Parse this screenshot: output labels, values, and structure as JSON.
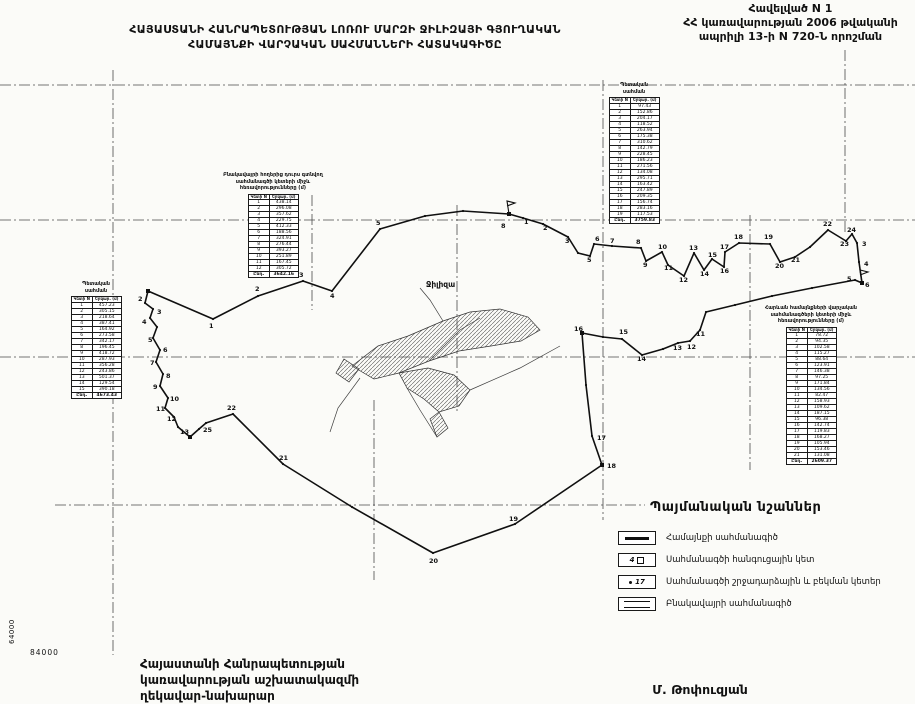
{
  "header": {
    "title_line1": "ՀԱՅԱՍՏԱՆԻ ՀԱՆՐԱՊԵՏՈՒԹՅԱՆ ԼՈՌՈՒ ՄԱՐԶԻ ՋԻԼԻԶԱՅԻ ԳՅՈՒՂԱԿԱՆ",
    "title_line2": "ՀԱՄԱՅՆՔԻ ՎԱՐՉԱԿԱՆ ՍԱՀՄԱՆՆԵՐԻ ՀԱՏԱԿԱԳԻԾԸ",
    "annex_line1": "Հավելված N 1",
    "annex_line2": "ՀՀ կառավարության 2006 թվականի",
    "annex_line3": "ապրիլի 13-ի N 720-Ն որոշման"
  },
  "map": {
    "settlement_label": "Ջիլիզա",
    "settlement_label_x": 426,
    "settlement_label_y": 287,
    "coord_vertical": "64000",
    "coord_horizontal": "84000",
    "boundary": [
      [
        148,
        291
      ],
      [
        145,
        303
      ],
      [
        153,
        309
      ],
      [
        150,
        318
      ],
      [
        157,
        327
      ],
      [
        153,
        338
      ],
      [
        160,
        350
      ],
      [
        156,
        362
      ],
      [
        163,
        374
      ],
      [
        160,
        386
      ],
      [
        168,
        398
      ],
      [
        165,
        408
      ],
      [
        174,
        417
      ],
      [
        178,
        427
      ],
      [
        190,
        437
      ],
      [
        199,
        429
      ],
      [
        206,
        423
      ],
      [
        233,
        414
      ],
      [
        283,
        464
      ],
      [
        352,
        507
      ],
      [
        433,
        553
      ],
      [
        515,
        524
      ],
      [
        602,
        465
      ],
      [
        592,
        436
      ],
      [
        586,
        385
      ],
      [
        582,
        333
      ],
      [
        603,
        337
      ],
      [
        622,
        339
      ],
      [
        642,
        355
      ],
      [
        663,
        349
      ],
      [
        678,
        343
      ],
      [
        690,
        341
      ],
      [
        700,
        330
      ],
      [
        706,
        312
      ],
      [
        735,
        305
      ],
      [
        772,
        296
      ],
      [
        812,
        288
      ],
      [
        855,
        280
      ],
      [
        862,
        283
      ],
      [
        859,
        262
      ],
      [
        857,
        243
      ],
      [
        852,
        234
      ],
      [
        846,
        241
      ],
      [
        828,
        230
      ],
      [
        810,
        247
      ],
      [
        795,
        257
      ],
      [
        780,
        262
      ],
      [
        770,
        244
      ],
      [
        739,
        243
      ],
      [
        725,
        252
      ],
      [
        724,
        267
      ],
      [
        712,
        259
      ],
      [
        704,
        270
      ],
      [
        694,
        253
      ],
      [
        684,
        276
      ],
      [
        668,
        265
      ],
      [
        662,
        252
      ],
      [
        646,
        261
      ],
      [
        641,
        248
      ],
      [
        612,
        246
      ],
      [
        594,
        244
      ],
      [
        590,
        256
      ],
      [
        578,
        253
      ],
      [
        568,
        237
      ],
      [
        543,
        224
      ],
      [
        523,
        218
      ],
      [
        509,
        214
      ],
      [
        463,
        211
      ],
      [
        425,
        216
      ],
      [
        380,
        229
      ],
      [
        332,
        291
      ],
      [
        303,
        281
      ],
      [
        258,
        296
      ],
      [
        213,
        319
      ]
    ],
    "point_labels": [
      {
        "t": "1",
        "x": 209,
        "y": 328
      },
      {
        "t": "2",
        "x": 138,
        "y": 301
      },
      {
        "t": "3",
        "x": 157,
        "y": 314
      },
      {
        "t": "4",
        "x": 142,
        "y": 324
      },
      {
        "t": "5",
        "x": 148,
        "y": 342
      },
      {
        "t": "6",
        "x": 163,
        "y": 352
      },
      {
        "t": "7",
        "x": 150,
        "y": 365
      },
      {
        "t": "8",
        "x": 166,
        "y": 378
      },
      {
        "t": "9",
        "x": 153,
        "y": 389
      },
      {
        "t": "10",
        "x": 170,
        "y": 401
      },
      {
        "t": "11",
        "x": 156,
        "y": 411
      },
      {
        "t": "12",
        "x": 167,
        "y": 421
      },
      {
        "t": "13",
        "x": 180,
        "y": 434
      },
      {
        "t": "25",
        "x": 203,
        "y": 432
      },
      {
        "t": "22",
        "x": 227,
        "y": 410
      },
      {
        "t": "21",
        "x": 279,
        "y": 460
      },
      {
        "t": "20",
        "x": 429,
        "y": 563
      },
      {
        "t": "19",
        "x": 509,
        "y": 521
      },
      {
        "t": "18",
        "x": 607,
        "y": 468
      },
      {
        "t": "17",
        "x": 597,
        "y": 440
      },
      {
        "t": "16",
        "x": 574,
        "y": 331
      },
      {
        "t": "15",
        "x": 619,
        "y": 334
      },
      {
        "t": "14",
        "x": 637,
        "y": 361
      },
      {
        "t": "13",
        "x": 673,
        "y": 350
      },
      {
        "t": "12",
        "x": 687,
        "y": 349
      },
      {
        "t": "11",
        "x": 696,
        "y": 336
      },
      {
        "t": "2",
        "x": 255,
        "y": 291
      },
      {
        "t": "3",
        "x": 299,
        "y": 277
      },
      {
        "t": "4",
        "x": 330,
        "y": 298
      },
      {
        "t": "5",
        "x": 376,
        "y": 225
      },
      {
        "t": "8",
        "x": 501,
        "y": 228
      },
      {
        "t": "1",
        "x": 524,
        "y": 224
      },
      {
        "t": "2",
        "x": 543,
        "y": 230
      },
      {
        "t": "3",
        "x": 565,
        "y": 243
      },
      {
        "t": "5",
        "x": 587,
        "y": 262
      },
      {
        "t": "6",
        "x": 595,
        "y": 241
      },
      {
        "t": "7",
        "x": 610,
        "y": 243
      },
      {
        "t": "8",
        "x": 636,
        "y": 244
      },
      {
        "t": "9",
        "x": 643,
        "y": 267
      },
      {
        "t": "10",
        "x": 658,
        "y": 249
      },
      {
        "t": "11",
        "x": 664,
        "y": 270
      },
      {
        "t": "12",
        "x": 679,
        "y": 282
      },
      {
        "t": "13",
        "x": 689,
        "y": 250
      },
      {
        "t": "14",
        "x": 700,
        "y": 276
      },
      {
        "t": "15",
        "x": 708,
        "y": 257
      },
      {
        "t": "16",
        "x": 720,
        "y": 273
      },
      {
        "t": "17",
        "x": 720,
        "y": 249
      },
      {
        "t": "18",
        "x": 734,
        "y": 239
      },
      {
        "t": "19",
        "x": 764,
        "y": 239
      },
      {
        "t": "20",
        "x": 775,
        "y": 268
      },
      {
        "t": "21",
        "x": 791,
        "y": 262
      },
      {
        "t": "22",
        "x": 823,
        "y": 226
      },
      {
        "t": "23",
        "x": 840,
        "y": 246
      },
      {
        "t": "24",
        "x": 847,
        "y": 232
      },
      {
        "t": "3",
        "x": 862,
        "y": 246
      },
      {
        "t": "4",
        "x": 864,
        "y": 266
      },
      {
        "t": "5",
        "x": 847,
        "y": 281
      },
      {
        "t": "6",
        "x": 865,
        "y": 287
      }
    ],
    "junctions": [
      [
        148,
        291
      ],
      [
        509,
        214
      ],
      [
        190,
        437
      ],
      [
        862,
        283
      ],
      [
        582,
        333
      ],
      [
        602,
        465
      ]
    ],
    "flags": [
      [
        509,
        214
      ],
      [
        862,
        283
      ]
    ],
    "settlement": [
      [
        [
          352,
          366
        ],
        [
          378,
          346
        ],
        [
          408,
          336
        ],
        [
          443,
          321
        ],
        [
          470,
          312
        ],
        [
          500,
          309
        ],
        [
          528,
          317
        ],
        [
          540,
          330
        ],
        [
          521,
          341
        ],
        [
          491,
          346
        ],
        [
          459,
          351
        ],
        [
          429,
          361
        ],
        [
          399,
          373
        ],
        [
          374,
          379
        ]
      ],
      [
        [
          399,
          373
        ],
        [
          428,
          368
        ],
        [
          454,
          375
        ],
        [
          470,
          390
        ],
        [
          459,
          406
        ],
        [
          439,
          412
        ],
        [
          424,
          399
        ],
        [
          407,
          388
        ]
      ],
      [
        [
          344,
          359
        ],
        [
          359,
          369
        ],
        [
          349,
          382
        ],
        [
          336,
          373
        ]
      ],
      [
        [
          439,
          412
        ],
        [
          448,
          428
        ],
        [
          437,
          437
        ],
        [
          430,
          419
        ]
      ]
    ],
    "roads": [
      [
        [
          360,
          378
        ],
        [
          338,
          408
        ],
        [
          330,
          432
        ]
      ],
      [
        [
          470,
          390
        ],
        [
          520,
          368
        ],
        [
          560,
          346
        ]
      ],
      [
        [
          443,
          321
        ],
        [
          430,
          300
        ],
        [
          420,
          288
        ]
      ],
      [
        [
          429,
          361
        ],
        [
          460,
          330
        ],
        [
          480,
          318
        ]
      ],
      [
        [
          407,
          388
        ],
        [
          420,
          410
        ],
        [
          437,
          437
        ]
      ]
    ],
    "grid_h": [
      {
        "y": 85,
        "x1": 0,
        "x2": 915
      },
      {
        "y": 220,
        "x1": 0,
        "x2": 915
      },
      {
        "y": 357,
        "x1": 0,
        "x2": 915
      },
      {
        "y": 505,
        "x1": 55,
        "x2": 645
      }
    ],
    "grid_v": [
      {
        "x": 113,
        "y1": 70,
        "y2": 655
      },
      {
        "x": 312,
        "y1": 195,
        "y2": 310
      },
      {
        "x": 374,
        "y1": 400,
        "y2": 580
      },
      {
        "x": 457,
        "y1": 205,
        "y2": 412
      },
      {
        "x": 603,
        "y1": 80,
        "y2": 520
      },
      {
        "x": 750,
        "y1": 215,
        "y2": 470
      },
      {
        "x": 845,
        "y1": 50,
        "y2": 235
      }
    ]
  },
  "tables": {
    "left": {
      "title_lines": [
        "Պետական",
        "սահման"
      ],
      "columns": [
        "Կետի N",
        "Երկար. (մ)"
      ],
      "rows": [
        [
          "1",
          "457.23"
        ],
        [
          "2",
          "305.15"
        ],
        [
          "3",
          "218.64"
        ],
        [
          "4",
          "387.41"
        ],
        [
          "5",
          "164.92"
        ],
        [
          "6",
          "273.58"
        ],
        [
          "7",
          "342.17"
        ],
        [
          "8",
          "196.45"
        ],
        [
          "9",
          "418.72"
        ],
        [
          "10",
          "287.93"
        ],
        [
          "11",
          "356.28"
        ],
        [
          "12",
          "243.86"
        ],
        [
          "13",
          "501.37"
        ],
        [
          "14",
          "129.54"
        ],
        [
          "15",
          "390.18"
        ]
      ],
      "total_label": "Ընդ.",
      "total_value": "4673.43"
    },
    "middle": {
      "title_lines": [
        "Բնակավայրի հողերից դուրս գտնվող",
        "սահմանագծի կետերի միջև",
        "հեռավորությունները (մ)"
      ],
      "columns": [
        "Կետի N",
        "Երկար. (մ)"
      ],
      "rows": [
        [
          "1",
          "438.14"
        ],
        [
          "2",
          "296.08"
        ],
        [
          "3",
          "357.62"
        ],
        [
          "4",
          "229.75"
        ],
        [
          "5",
          "412.33"
        ],
        [
          "6",
          "188.56"
        ],
        [
          "7",
          "324.91"
        ],
        [
          "8",
          "276.44"
        ],
        [
          "9",
          "393.27"
        ],
        [
          "10",
          "251.89"
        ],
        [
          "11",
          "167.45"
        ],
        [
          "12",
          "305.72"
        ]
      ],
      "total_label": "Ընդ.",
      "total_value": "3642.16"
    },
    "top_right": {
      "title_lines": [
        "Պետական",
        "սահման"
      ],
      "columns": [
        "Կետի N",
        "Երկար. (մ)"
      ],
      "rows": [
        [
          "1",
          "97.43"
        ],
        [
          "2",
          "152.86"
        ],
        [
          "3",
          "204.17"
        ],
        [
          "4",
          "118.52"
        ],
        [
          "5",
          "263.94"
        ],
        [
          "6",
          "175.38"
        ],
        [
          "7",
          "310.62"
        ],
        [
          "8",
          "142.79"
        ],
        [
          "9",
          "228.45"
        ],
        [
          "10",
          "186.23"
        ],
        [
          "11",
          "271.56"
        ],
        [
          "12",
          "134.08"
        ],
        [
          "13",
          "295.71"
        ],
        [
          "14",
          "163.42"
        ],
        [
          "15",
          "247.89"
        ],
        [
          "16",
          "209.35"
        ],
        [
          "17",
          "156.74"
        ],
        [
          "18",
          "283.16"
        ],
        [
          "19",
          "117.53"
        ]
      ],
      "total_label": "Ընդ.",
      "total_value": "3759.83"
    },
    "right": {
      "title_lines": [
        "Հարևան համայնքների վարչական",
        "սահմանագծերի կետերի միջև",
        "հեռավորությունները (մ)"
      ],
      "columns": [
        "Կետի N",
        "Երկար. (մ)"
      ],
      "rows": [
        [
          "1",
          "78.72"
        ],
        [
          "2",
          "94.35"
        ],
        [
          "3",
          "102.58"
        ],
        [
          "4",
          "115.27"
        ],
        [
          "5",
          "88.64"
        ],
        [
          "6",
          "123.91"
        ],
        [
          "7",
          "146.38"
        ],
        [
          "8",
          "97.25"
        ],
        [
          "9",
          "171.84"
        ],
        [
          "10",
          "134.56"
        ],
        [
          "11",
          "82.47"
        ],
        [
          "12",
          "158.93"
        ],
        [
          "13",
          "109.62"
        ],
        [
          "14",
          "187.15"
        ],
        [
          "15",
          "96.38"
        ],
        [
          "16",
          "142.74"
        ],
        [
          "17",
          "119.83"
        ],
        [
          "18",
          "168.27"
        ],
        [
          "19",
          "105.94"
        ],
        [
          "20",
          "153.46"
        ],
        [
          "21",
          "131.08"
        ]
      ],
      "total_label": "Ընդ.",
      "total_value": "2609.37"
    }
  },
  "legend": {
    "title": "Պայմանական նշաններ",
    "items": [
      {
        "symbol": "community-boundary-line",
        "label": "Համայնքի սահմանագիծ"
      },
      {
        "symbol": "junction-point",
        "sample": "4",
        "label": "Սահմանագծի հանգուցային կետ"
      },
      {
        "symbol": "turning-point",
        "sample": "17",
        "label": "Սահմանագծի շրջադարձային և բեկման կետեր"
      },
      {
        "symbol": "settlement-boundary-line",
        "label": "Բնակավայրի սահմանագիծ"
      }
    ]
  },
  "footer": {
    "line1": "Հայաստանի Հանրապետության",
    "line2": "կառավարության աշխատակազմի",
    "line3": "ղեկավար-նախարար",
    "signature": "Մ. Թոփուզյան"
  }
}
